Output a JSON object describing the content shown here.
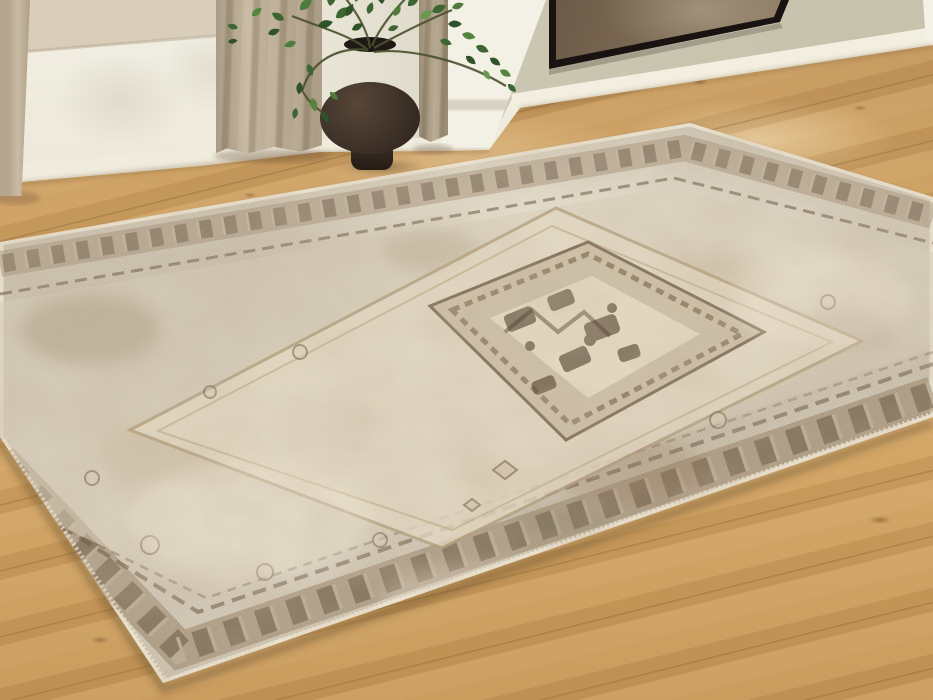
{
  "meta": {
    "description": "Photograph of a faded vintage-style medallion area rug lying diagonally on a light oak plank floor; behind it a white wainscoted wall with beige curtains, a dark brown gourd-shaped vase holding green leafy branches, a white fireplace pillar, and a black-framed bronze abstract canvas on a sage-green wall.",
    "width_px": 933,
    "height_px": 700
  },
  "palette": {
    "wall_band": "#d9ceba",
    "wall_white": "#f1eee3",
    "wall_mid": "#ddd8c8",
    "wall_sage": "#d0ccb8",
    "trim_white": "#f3f0e5",
    "baseboard": "#efebdd",
    "curtain_light": "#c9bba4",
    "curtain_dark": "#ab9c84",
    "vase_dark": "#3a2e25",
    "vase_light": "#5a4a3c",
    "leaf_main": "#3c6631",
    "leaf_dark": "#2f5226",
    "leaf_light": "#69984f",
    "stem": "#49512f",
    "art_frame": "#181310",
    "art_dark": "#2f251c",
    "art_light": "#b3a086",
    "floor_base": "#cd9f60",
    "floor_seam": "#7c582e",
    "rug_base": "#cbc1ae",
    "rug_cream": "#e2d8c2",
    "rug_tan": "#c9bba2",
    "rug_brown": "#8d7659",
    "rug_darkbrown": "#57452f",
    "rug_rust": "#b97f4e",
    "rug_olive": "#8a8464",
    "shadow": "#50402c"
  },
  "scene": {
    "room": {
      "label": "living room corner with area rug"
    },
    "wall": {
      "label": "room walls",
      "band_label": "beige upper wall band",
      "wainscot_label": "white lower wall panel",
      "mid_label": "shadowed wall behind vase",
      "sage_label": "sage green fireplace wall",
      "pillar_label": "white fireplace pillar corner",
      "baseboard_label": "white baseboard",
      "trim_label": "white corner trim at right edge"
    },
    "curtains": {
      "label": "beige linen curtains",
      "panels": [
        "far-left curtain edge",
        "main curtain panel",
        "right curtain edge"
      ]
    },
    "vase": {
      "label": "dark brown double-gourd vase"
    },
    "plant": {
      "label": "green leafy branches in vase"
    },
    "artwork": {
      "label": "black-framed abstract bronze canvas"
    },
    "floor": {
      "label": "light oak plank floor"
    },
    "rug": {
      "label": "faded vintage medallion area rug",
      "parts": {
        "binding_label": "pale outer binding",
        "border_label": "brown ornamental border band",
        "field_label": "distressed beige field",
        "panel_label": "cream inner panel",
        "medallion_label": "brown center medallion diamond"
      }
    }
  }
}
